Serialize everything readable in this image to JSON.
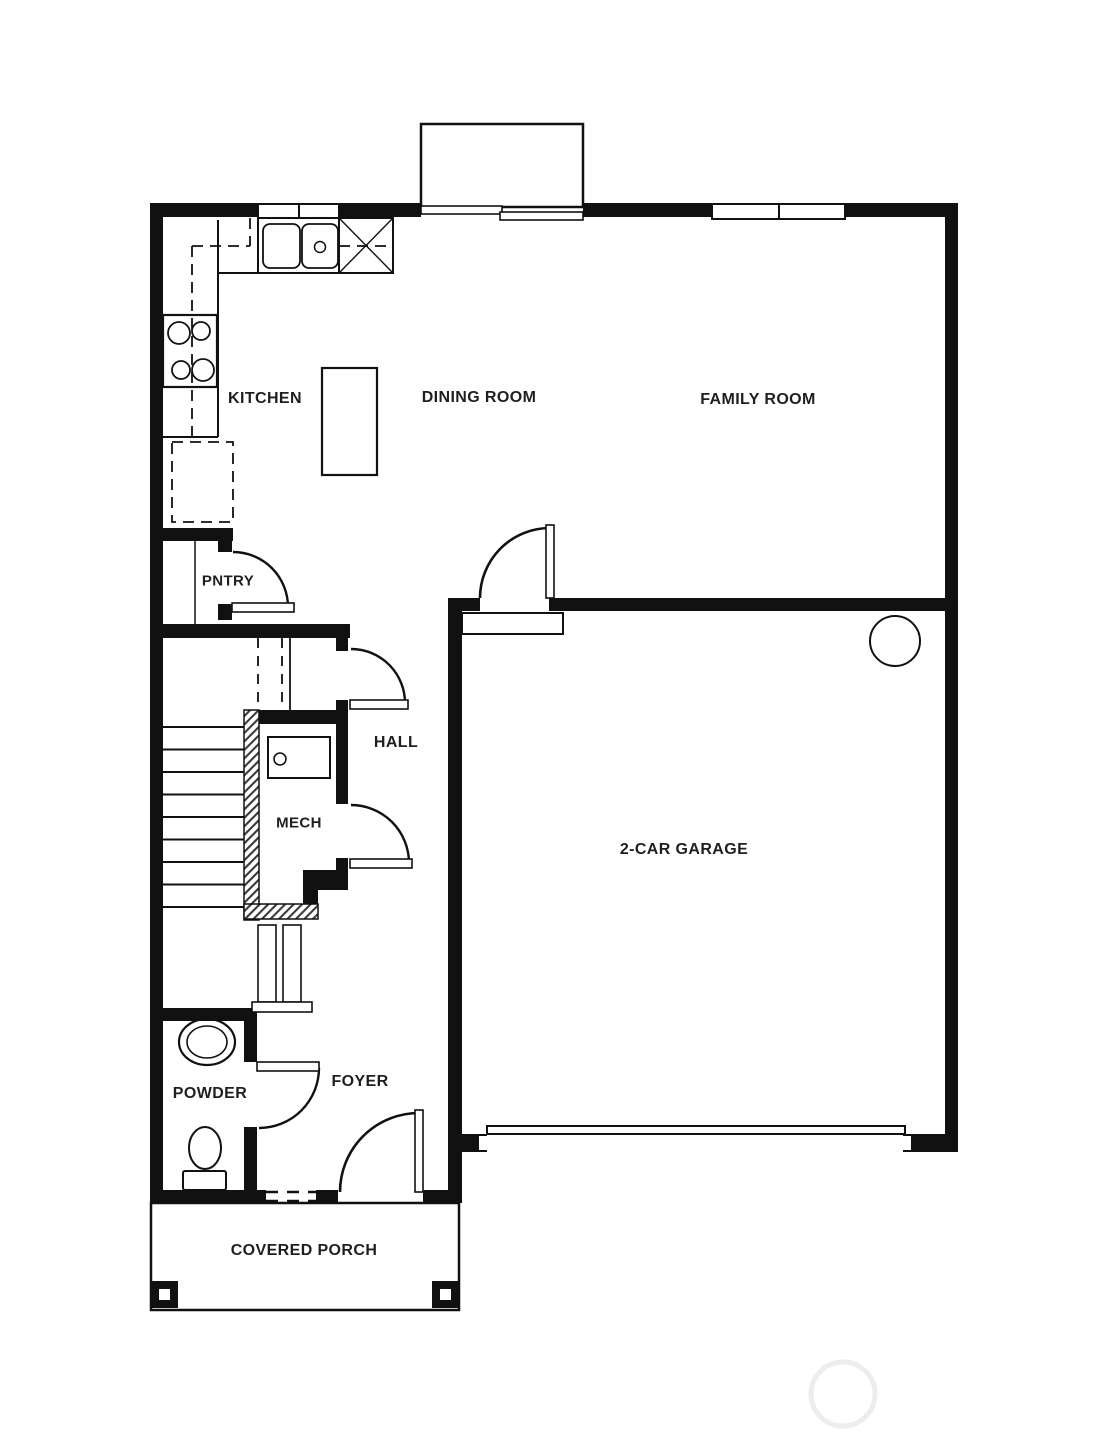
{
  "background_color": "#ffffff",
  "wall_color": "#111111",
  "label_color": "#1f1f1f",
  "watermark_color": "#ededed",
  "rooms": [
    {
      "name": "kitchen",
      "label": "KITCHEN"
    },
    {
      "name": "dining-room",
      "label": "DINING ROOM"
    },
    {
      "name": "family-room",
      "label": "FAMILY ROOM"
    },
    {
      "name": "pantry",
      "label": "PNTRY"
    },
    {
      "name": "hall",
      "label": "HALL"
    },
    {
      "name": "mech-room",
      "label": "MECH"
    },
    {
      "name": "garage",
      "label": "2-CAR GARAGE"
    },
    {
      "name": "powder-room",
      "label": "POWDER"
    },
    {
      "name": "foyer",
      "label": "FOYER"
    },
    {
      "name": "covered-porch",
      "label": "COVERED PORCH"
    }
  ],
  "fixtures": [
    "double-sink",
    "range-cooktop",
    "x-marked-appliance",
    "refrigerator",
    "kitchen-island",
    "pantry-shelf",
    "stairs",
    "stair-railing",
    "water-heater",
    "powder-sink",
    "toilet",
    "garage-column",
    "porch-posts",
    "sliding-patio-door",
    "overhead-garage-door",
    "front-door"
  ]
}
